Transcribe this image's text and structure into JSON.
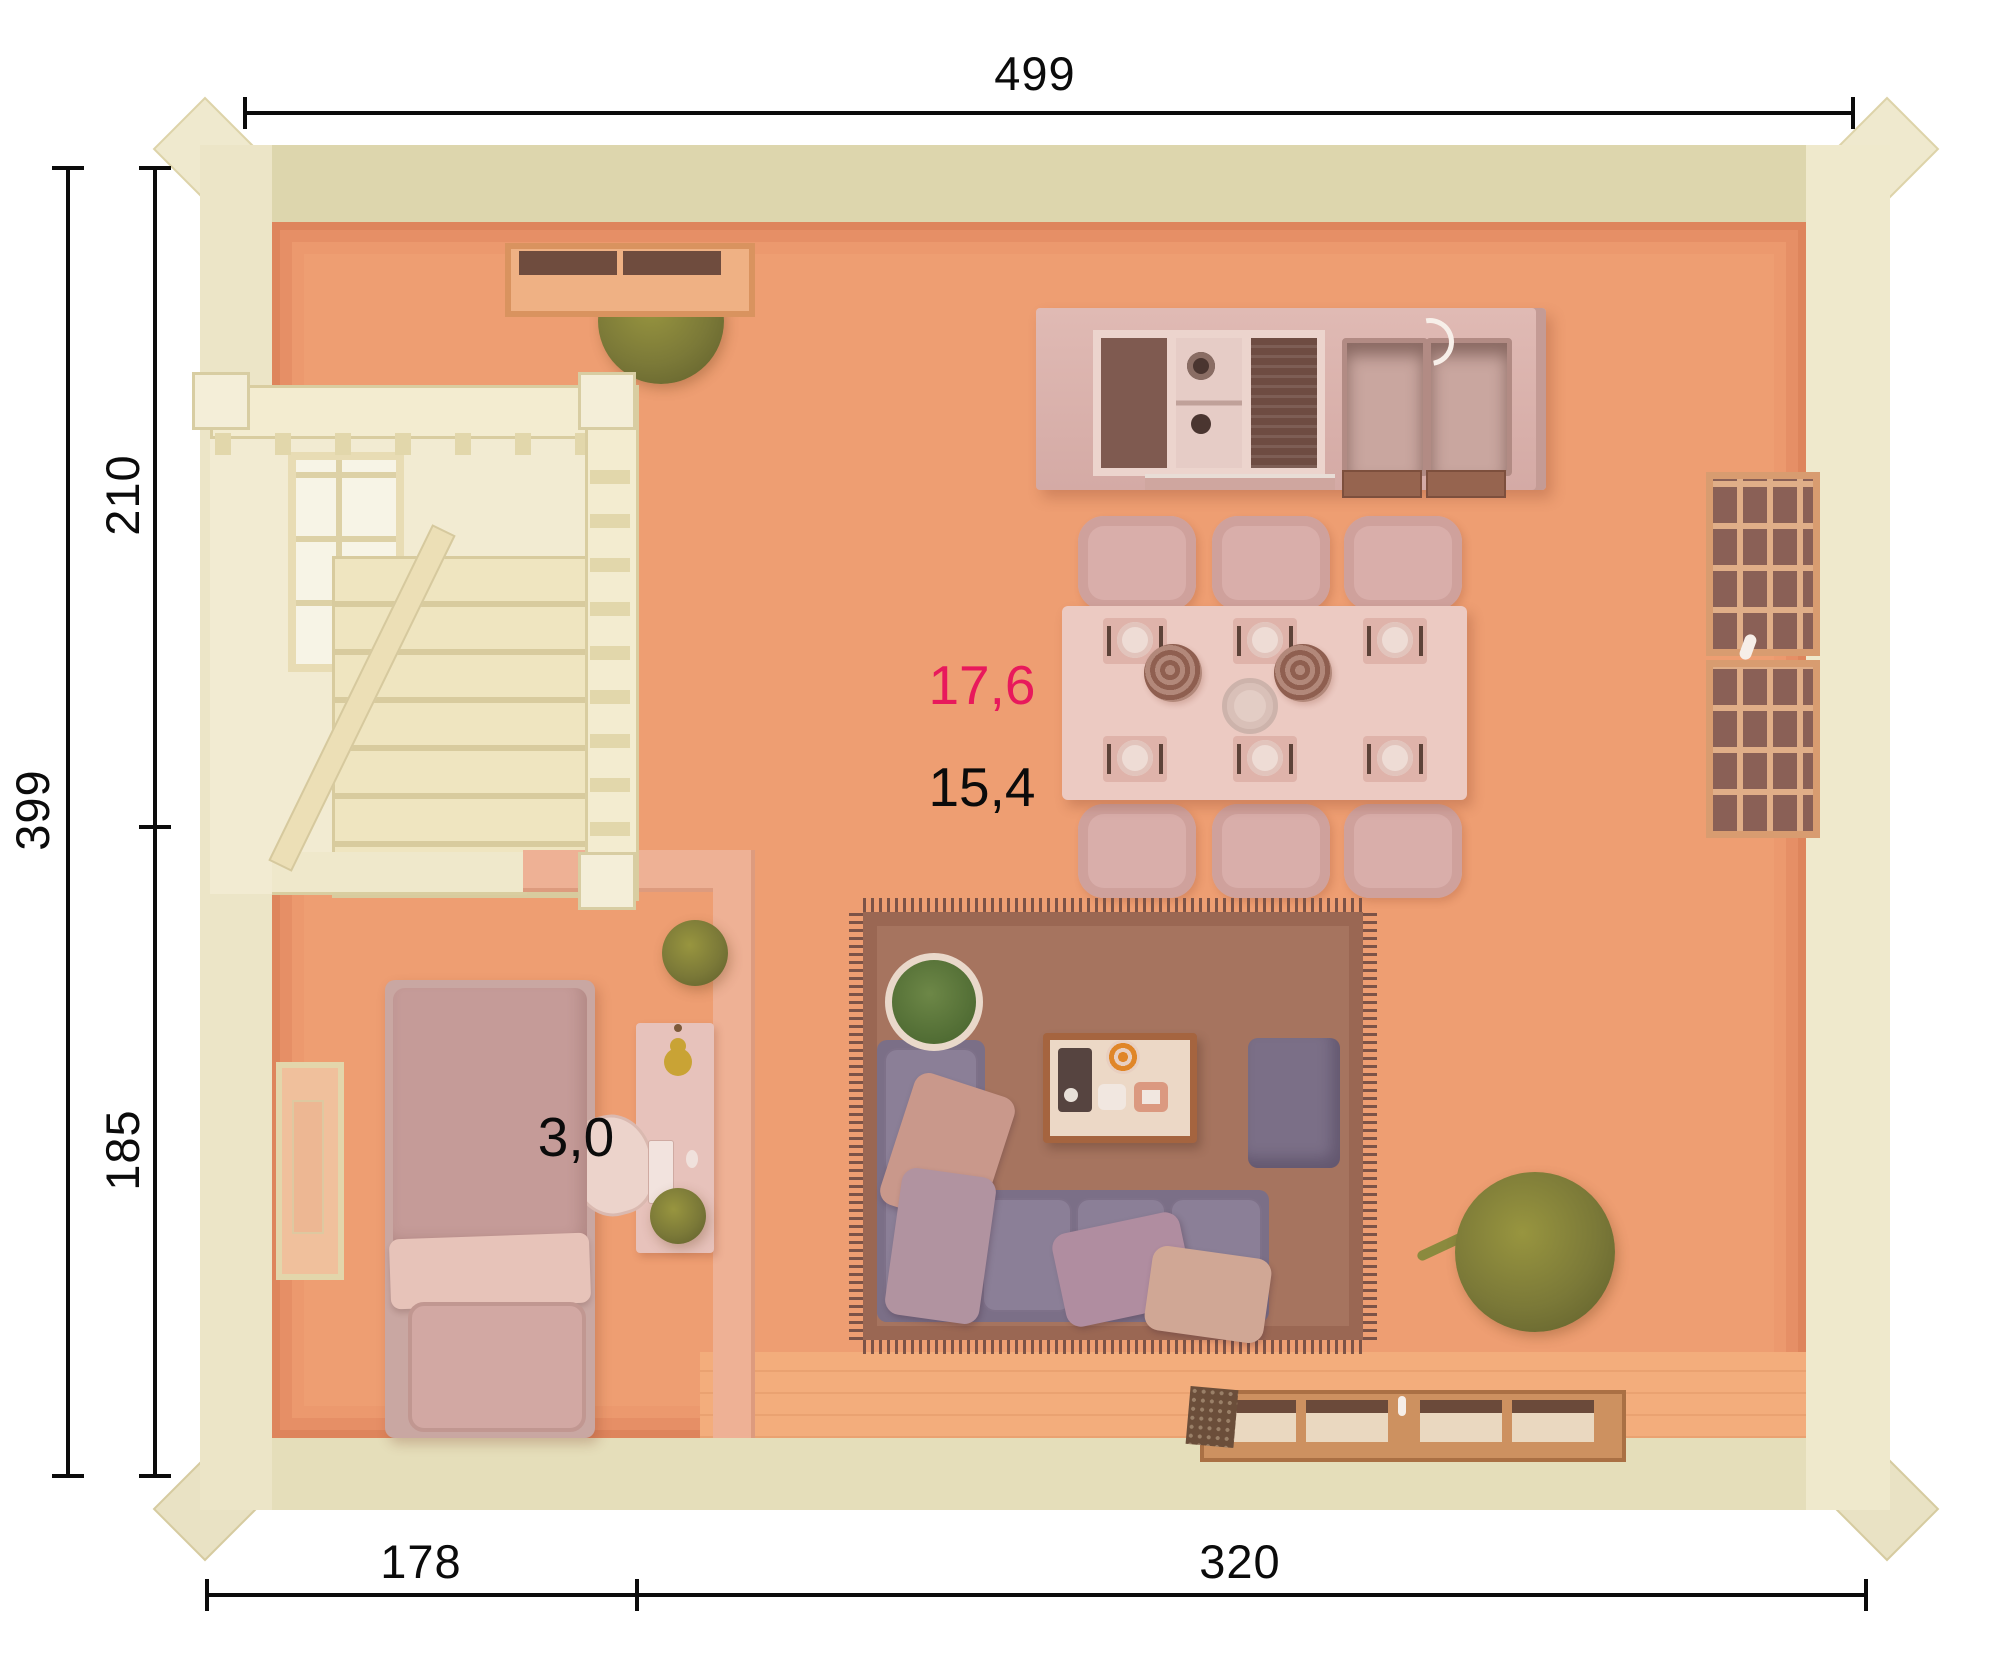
{
  "dimensions": {
    "width_total": "499",
    "height_total": "399",
    "height_upper": "210",
    "height_lower": "185",
    "width_bottom_left": "178",
    "width_bottom_right": "320"
  },
  "areas": {
    "living_red": "17,6",
    "living_black": "15,4",
    "bedroom": "3,0"
  },
  "colors": {
    "accent_red": "#e8195c",
    "dimension_black": "#0b0b0b",
    "floor_salmon": "#ee9e72",
    "outer_wall_wood": "#eee8cb",
    "furniture_pink": "#dcb3ad",
    "sofa_gray": "#7b6f87",
    "rug_brown": "#a6745f",
    "plant_olive": "#7b7938"
  }
}
